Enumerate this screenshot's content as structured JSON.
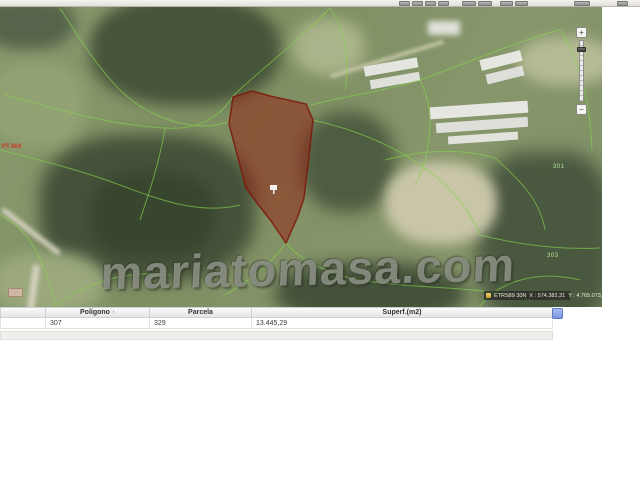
{
  "toolbar": {
    "icons": [
      "tool-icon-1",
      "tool-icon-2",
      "tool-icon-3",
      "tool-icon-4",
      "tool-icon-5",
      "tool-icon-6",
      "tool-icon-7",
      "tool-icon-8",
      "tool-icon-9",
      "tool-icon-10"
    ]
  },
  "map": {
    "watermark": "mariatomasa.com",
    "road_label": "PT-804",
    "parcel_labels": [
      "301",
      "303"
    ],
    "zoom": {
      "in_label": "+",
      "out_label": "−"
    },
    "status_bar": {
      "datum": "ETRS89 30N",
      "x_coord": "X : 574.382,31",
      "y_coord": "Y : 4.765.073,37"
    }
  },
  "table": {
    "headers": {
      "blank": "",
      "poligono": "Polígono",
      "parcela": "Parcela",
      "superf": "Superf.(m2)"
    },
    "sort_indicator": "↑",
    "rows": [
      {
        "blank": "",
        "poligono": "307",
        "parcela": "329",
        "superf": "13.445,29"
      }
    ]
  },
  "colors": {
    "selected_parcel_fill": "#96281e",
    "parcel_line_green": "#86d34f",
    "scroll_button_blue": "#7a96df",
    "status_bar_bg": "#2a2c28"
  }
}
